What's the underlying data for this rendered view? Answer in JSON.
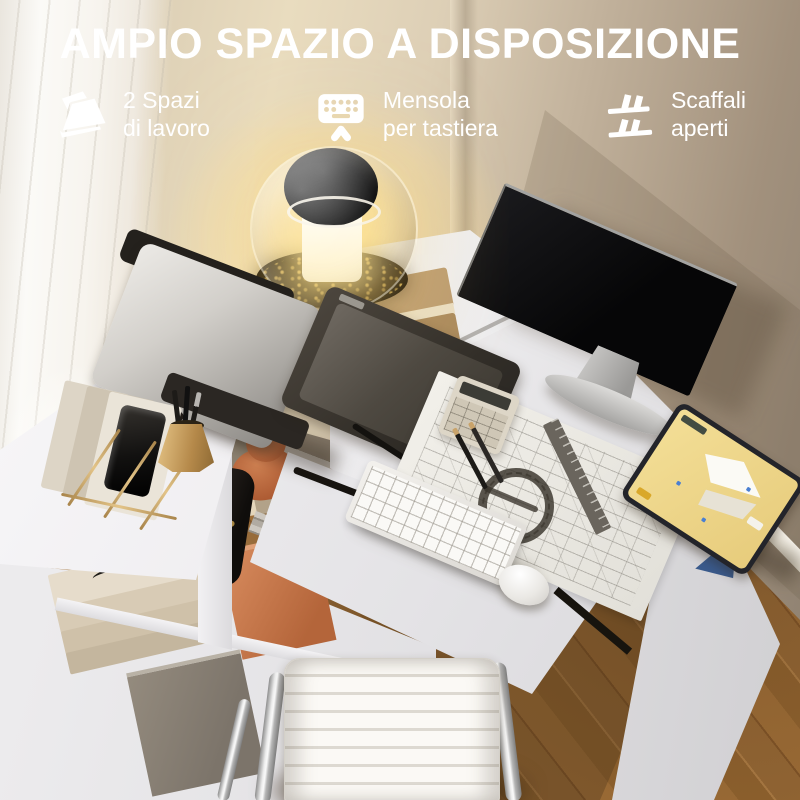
{
  "header": {
    "title": "AMPIO SPAZIO A DISPOSIZIONE",
    "features": [
      {
        "icon": "two-tier-desk-icon",
        "line1": "2 Spazi",
        "line2": "di lavoro"
      },
      {
        "icon": "keyboard-tray-icon",
        "line1": "Mensola",
        "line2": "per tastiera"
      },
      {
        "icon": "open-shelves-icon",
        "line1": "Scaffali",
        "line2": "aperti"
      }
    ]
  },
  "scene": {
    "book_spine_text": "DANTE",
    "colors": {
      "text": "#ffffff",
      "wall_beige": "#d9cbb2",
      "desk_white": "#eeedef",
      "floor_wood": "#9a6a35",
      "lamp_glow": "#ffe28c",
      "terracotta_box": "#b4653a",
      "brass_gold": "#c9a76b",
      "tablet_screen_yellow": "#eed88f",
      "chair_white": "#f6f4f0",
      "monitor_black": "#0a0a0c",
      "stand_blue": "#3a5a8c"
    }
  }
}
